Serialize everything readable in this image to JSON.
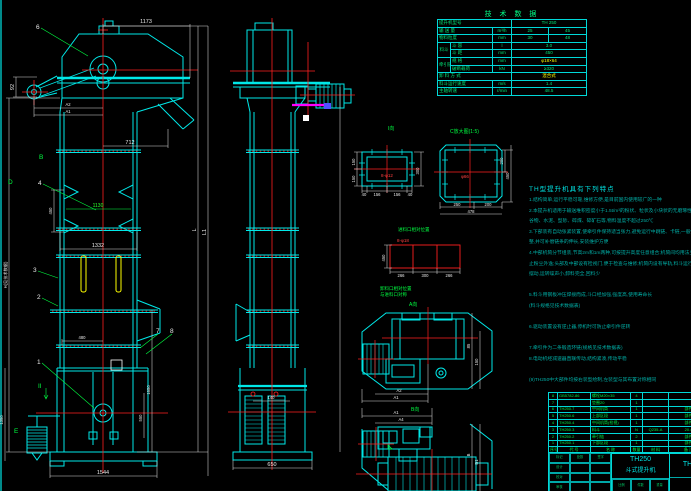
{
  "app": {
    "type": "cad-drawing",
    "subject": "TH250 bucket elevator assembly drawing",
    "bg": "#000000"
  },
  "colors": {
    "geometry": "#00e8e8",
    "centerline": "#ff2020",
    "dimension": "#e8e8e8",
    "label_green": "#00ff41",
    "highlight_yellow": "#ffff00",
    "magenta": "#ff00ff",
    "notes_teal": "#00ada5"
  },
  "tech_table": {
    "title": "技 术 数 据",
    "model_label": "提升机型号",
    "model_value": "TH 250",
    "capacity_label": "输 送 量",
    "capacity_unit": "m³/h",
    "capacity_v1": "25",
    "capacity_v2": "45",
    "grain_label": "物料粒度",
    "grain_unit": "mm",
    "grain_v1": "30",
    "grain_v2": "48",
    "bucket_group": "料斗",
    "bucket_vol_label": "斗 容",
    "bucket_vol_unit": "l",
    "bucket_vol_value": "3.0",
    "bucket_pitch_label": "斗 距",
    "bucket_pitch_unit": "mm",
    "bucket_pitch_value": "450",
    "chain_group": "牵引链",
    "chain_spec_label": "规 格",
    "chain_spec_unit": "mm",
    "chain_spec_value": "φ18×64",
    "chain_break_label": "破断载荷",
    "chain_break_unit": "kN",
    "chain_break_value": "≥320",
    "discharge_label": "卸 料 方 式",
    "discharge_value": "混合式",
    "speed_label": "料斗运行速度",
    "speed_unit": "m/s",
    "speed_value": "1.4",
    "rpm_label": "主轴转速",
    "rpm_unit": "r/min",
    "rpm_value": "48.5"
  },
  "notes": {
    "title": "TH型提升机具有下列特点",
    "lines": [
      "1.结构简单,运行平稳可靠,维修方便,是目前国内使用较广的一种",
      "2.本提升机适用于输送堆积密度小于1.5t/m³的粉状、粒状及小块状的无磨琢性、半磨琢性物料,如:",
      "  谷物、水泥、型砂、碎煤、碎矿石等,物料温度不超过250℃",
      "3.下部装有自动张紧装置,使牵引件保持适当张力,避免运行中跳链、卡链,一般情况下不需经常调",
      "  整,并可补偿链条的伸长,安装维护方便",
      "4.中部机筒分节组装,节高2m和1m两种,可按提升高度任意组合;机筒间均用法兰联接,密封性好,防",
      "  止粉尘外逸;头部及中部设有检视门,便于检查与维修;机筒内设有导轨,料斗运行平稳,不致左右",
      "  摆动,运转噪声小,卸料完全,回料少",
      "",
      "5.料斗用钢板冲压焊接而成,斗口经加强,强度高,使用寿命长",
      "  (料斗规格见技术数据表)",
      "",
      "6.驱动装置设有逆止器,停机时可防止牵引件逆转",
      "",
      "7.牵引件为二条锻造环链(规格见技术数据表)",
      "8.电动机经减速器直联传动,结构紧凑,传动平稳",
      "",
      "(9)TH250中大部件均按右装型绘制,左装型与其布置对称相同"
    ]
  },
  "bom": {
    "headers": [
      "序号",
      "代  号",
      "名  称",
      "数量",
      "材 料",
      "备 注"
    ],
    "rows": [
      [
        "8",
        "GB5782-86",
        "螺栓M20×35",
        "4",
        "",
        ""
      ],
      [
        "7",
        "",
        "垫圈20",
        "1",
        "",
        ""
      ],
      [
        "6",
        "TH250.7",
        "中间机筒",
        "1",
        "",
        "部件"
      ],
      [
        "5",
        "TH250.6",
        "上部区段",
        "1",
        "",
        "部件"
      ],
      [
        "4",
        "TH250.4",
        "中间机筒(检视)",
        "1",
        "",
        "部件"
      ],
      [
        "3",
        "TH250.3",
        "料斗",
        "N",
        "Q235-A",
        "20.4"
      ],
      [
        "2",
        "TH250.2",
        "牵引链",
        "2",
        "",
        "部件"
      ],
      [
        "1",
        "TH250.1",
        "下部区段",
        "1",
        "",
        "部件"
      ]
    ]
  },
  "title_block": {
    "model": "TH250",
    "name": "斗式提升机",
    "drawing_no": "TH2",
    "left_rows": [
      [
        "标记",
        "处数",
        "签字"
      ],
      [
        "设计",
        "",
        ""
      ],
      [
        "校对",
        "",
        ""
      ],
      [
        "审核",
        "",
        ""
      ]
    ],
    "bottom_cells": [
      "比例",
      "件数",
      "重量"
    ]
  },
  "views": {
    "view_i": "I向",
    "view_c": "C放大图(1:5)",
    "feed_title": "进料口相对位置",
    "flange_note1": "卸料口相对位置",
    "flange_note2": "与进料口对称",
    "view_a": "A向",
    "view_b": "B向"
  },
  "dims": {
    "top_width": "1173",
    "head_h": "92",
    "a2": "A2",
    "a1": "A1",
    "chute": "712",
    "pitch": "450",
    "mid_green": "1130",
    "mid_width": "1332",
    "boot_door": "480",
    "base_width": "1544",
    "boot_left_h": "1350",
    "boot_right_h": "1650",
    "boot_inner_h": "550",
    "total_h": "H(见技术数据)",
    "len_l": "L",
    "len_l1": "L1",
    "mid_top": "140",
    "mid_base": "650",
    "vi_left_a": "150",
    "vi_left_b": "150",
    "vi_right": "300",
    "vi_b1": "40",
    "vi_b2": "156",
    "vi_b3": "156",
    "vi_b4": "40",
    "vi_holes": "8-φ12",
    "vc_center": "φ66",
    "vc_right_a": "200",
    "vc_right_b": "450",
    "vc_b1": "250",
    "vc_b2": "200",
    "vc_total": "478",
    "feed_left": "450",
    "feed_b1": "266",
    "feed_b2": "300",
    "feed_b3": "266",
    "feed_holes": "8-φ18",
    "va_r1": "85",
    "va_r2": "150",
    "va_a2": "A2",
    "va_a1": "A1",
    "vb_a1": "A1",
    "vb_a4": "A4",
    "vb_b": "B",
    "vb_b1": "B1"
  },
  "callouts": {
    "b1": "1",
    "b2": "2",
    "b3": "3",
    "b4": "4",
    "b6": "6",
    "b7": "7",
    "b8": "8",
    "lB": "B",
    "lD": "D",
    "lII": "II",
    "lE": "E"
  }
}
